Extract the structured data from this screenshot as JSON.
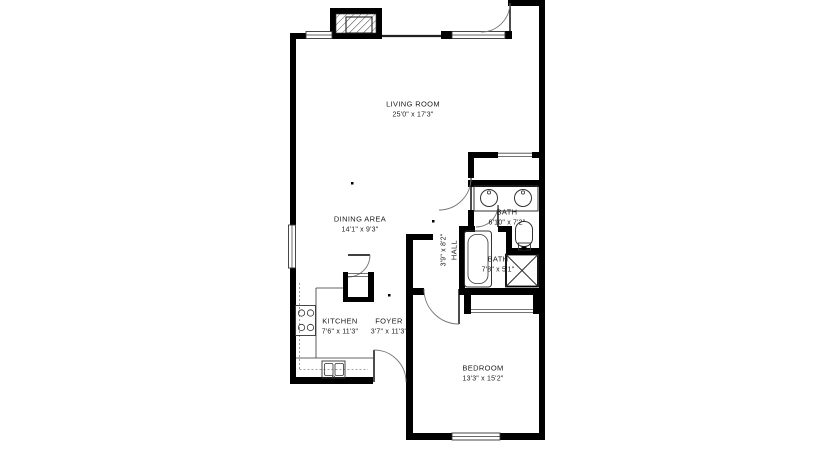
{
  "floorplan": {
    "rooms": [
      {
        "name": "LIVING ROOM",
        "dims": "25'0\" x 17'3\""
      },
      {
        "name": "DINING AREA",
        "dims": "14'1\" x 9'3\""
      },
      {
        "name": "KITCHEN",
        "dims": "7'6\" x 11'3\""
      },
      {
        "name": "FOYER",
        "dims": "3'7\" x 11'3\""
      },
      {
        "name": "HALL",
        "dims": "3'9\" x 8'2\""
      },
      {
        "name": "BATH",
        "dims": "6'10\" x 7'2\""
      },
      {
        "name": "BATH",
        "dims": "7'8\" x 5'1\""
      },
      {
        "name": "BEDROOM",
        "dims": "13'3\" x 15'2\""
      }
    ],
    "fixtures": [
      "fireplace-icon",
      "double-vanity-sinks-icon",
      "bathtub-icon",
      "toilet-icon",
      "shower-icon",
      "stove-icon",
      "kitchen-sink-icon",
      "sliding-closet-doors",
      "door-swing-arcs",
      "windows"
    ],
    "colors": {
      "walls": "#000000",
      "background": "#ffffff",
      "text": "#1c1c1c"
    }
  }
}
